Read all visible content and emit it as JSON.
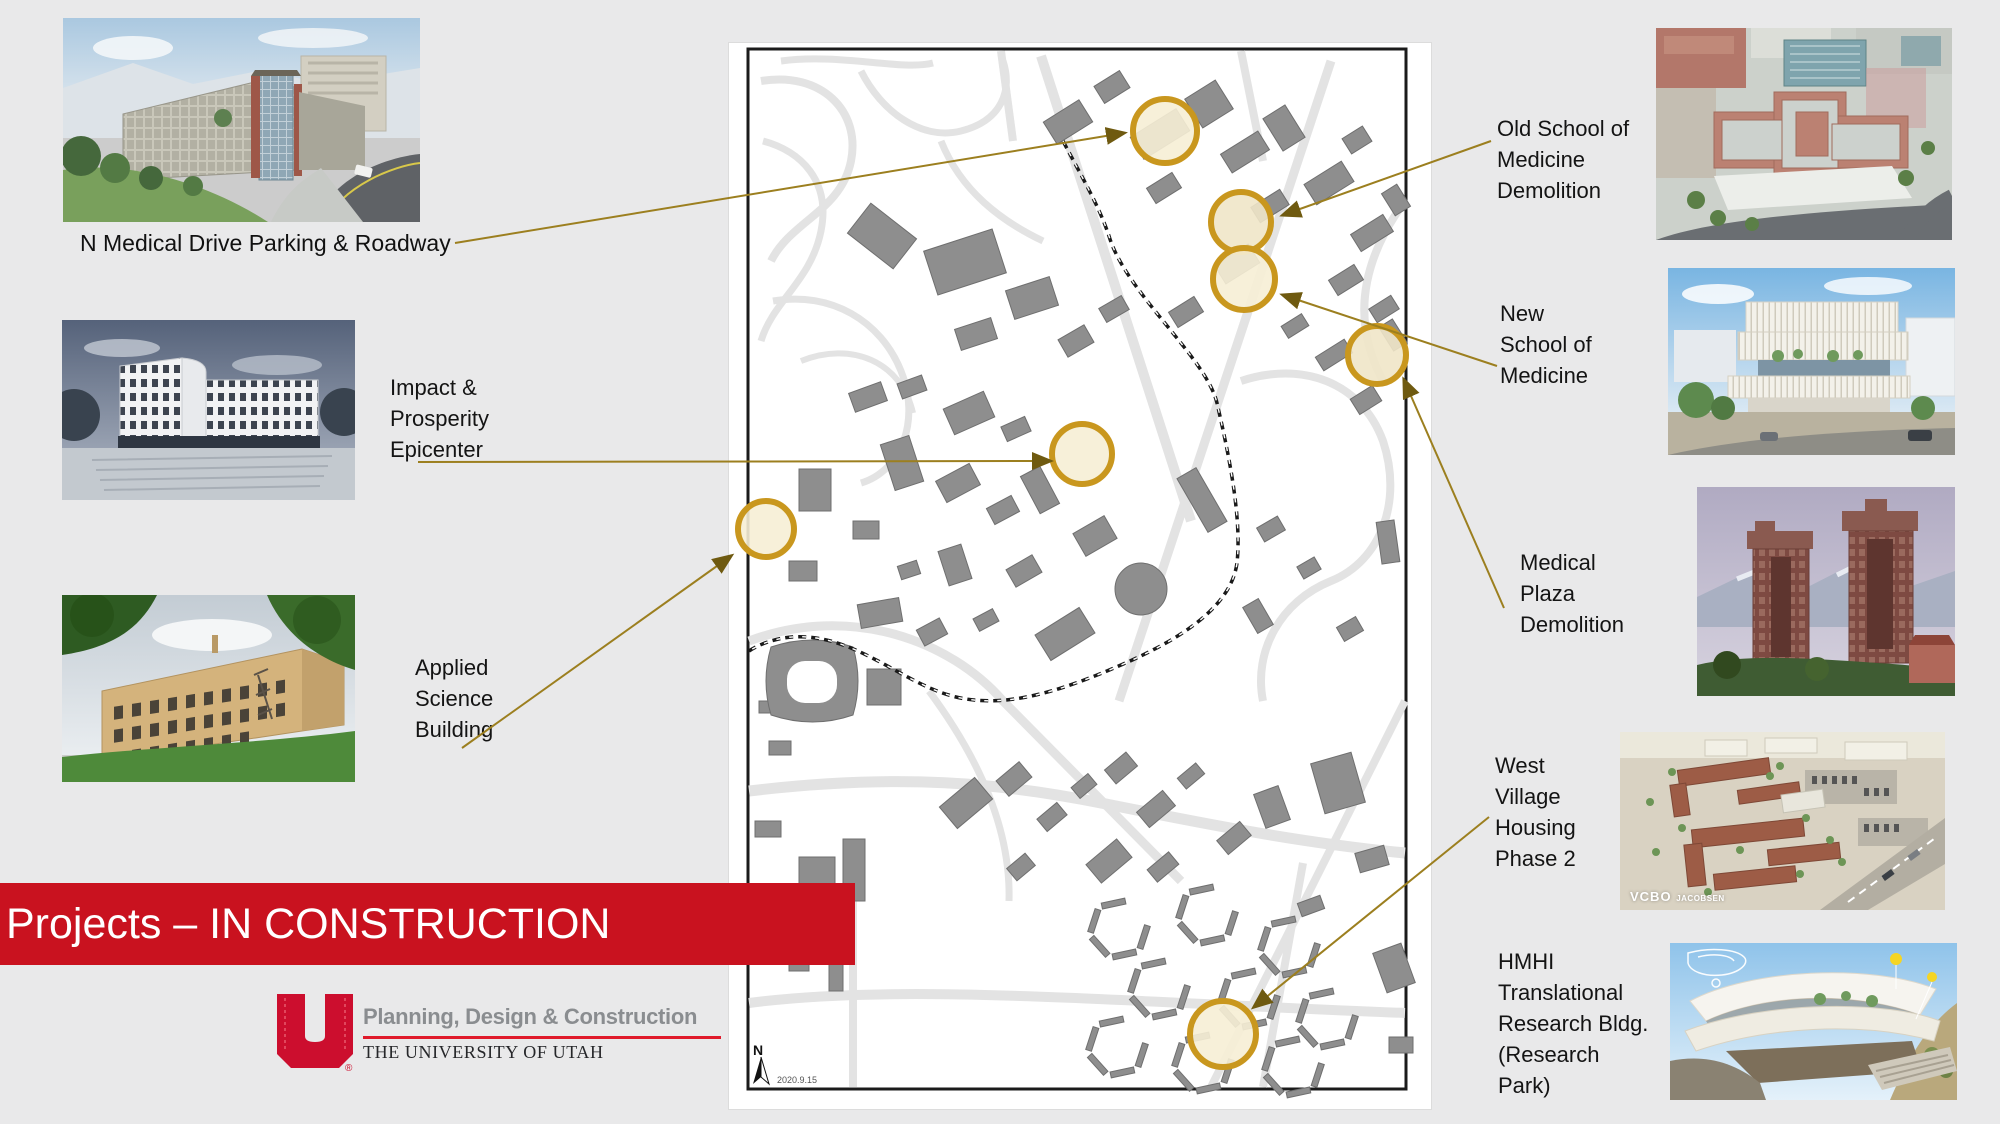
{
  "slide": {
    "title": "Projects – IN CONSTRUCTION"
  },
  "logo": {
    "mark": "U",
    "registered": "®",
    "department": "Planning, Design & Construction",
    "institution": "THE UNIVERSITY OF UTAH"
  },
  "map": {
    "north": "N",
    "date": "2020.9.15"
  },
  "left_projects": [
    {
      "id": "n-medical-drive-parking",
      "caption": "N Medical Drive Parking & Roadway"
    },
    {
      "id": "impact-prosperity-epicenter",
      "lines": [
        "Impact &",
        "Prosperity",
        "Epicenter"
      ]
    },
    {
      "id": "applied-science-building",
      "lines": [
        "Applied",
        "Science",
        "Building"
      ]
    }
  ],
  "right_projects": [
    {
      "id": "old-school-of-medicine",
      "lines": [
        "Old School of",
        "Medicine",
        "Demolition"
      ]
    },
    {
      "id": "new-school-of-medicine",
      "lines": [
        "New",
        "School of",
        "Medicine"
      ]
    },
    {
      "id": "medical-plaza-demolition",
      "lines": [
        "Medical",
        "Plaza",
        "Demolition"
      ]
    },
    {
      "id": "west-village-housing",
      "lines": [
        "West",
        "Village",
        "Housing",
        "Phase 2"
      ]
    },
    {
      "id": "hmhi-translational-research",
      "lines": [
        "HMHI",
        "Translational",
        "Research Bldg.",
        "(Research",
        "Park)"
      ]
    }
  ],
  "photo_credit": {
    "vcbo": "VCBO",
    "jacobsen": "JACOBSEN"
  },
  "colors": {
    "banner_red": "#c9121f",
    "logo_red": "#cc0e2e",
    "marker_gold": "#c9971e",
    "marker_fill": "#f8f1d9",
    "leader_line": "#9c7f1f"
  }
}
